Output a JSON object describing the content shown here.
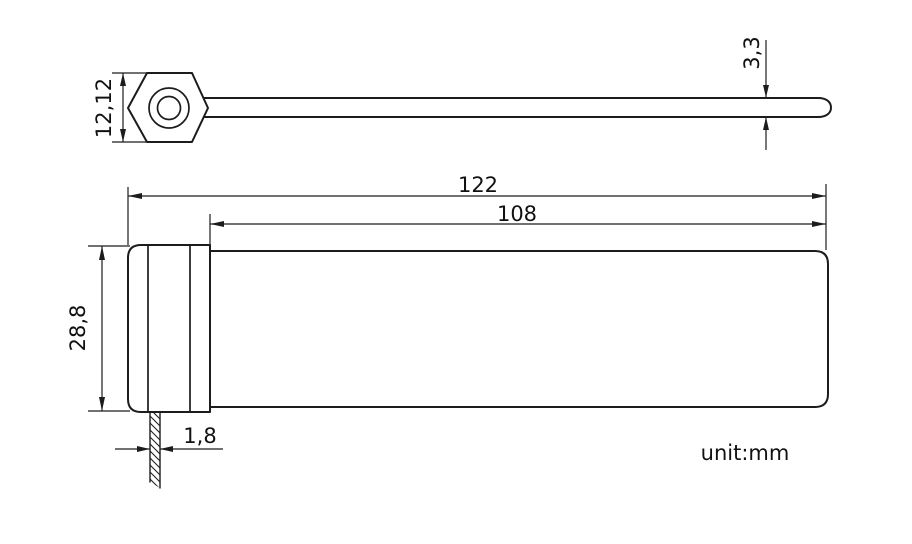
{
  "drawing": {
    "unit_note": "unit:mm",
    "views": {
      "side_view": {
        "dimensions": {
          "head_height": "12,12",
          "strap_thickness": "3,3"
        }
      },
      "plan_view": {
        "dimensions": {
          "overall_length": "122",
          "strap_length": "108",
          "body_width": "28,8",
          "tail_width": "1,8"
        }
      }
    }
  },
  "colors": {
    "line": "#1c1c1c",
    "text": "#111111",
    "background": "#ffffff"
  }
}
